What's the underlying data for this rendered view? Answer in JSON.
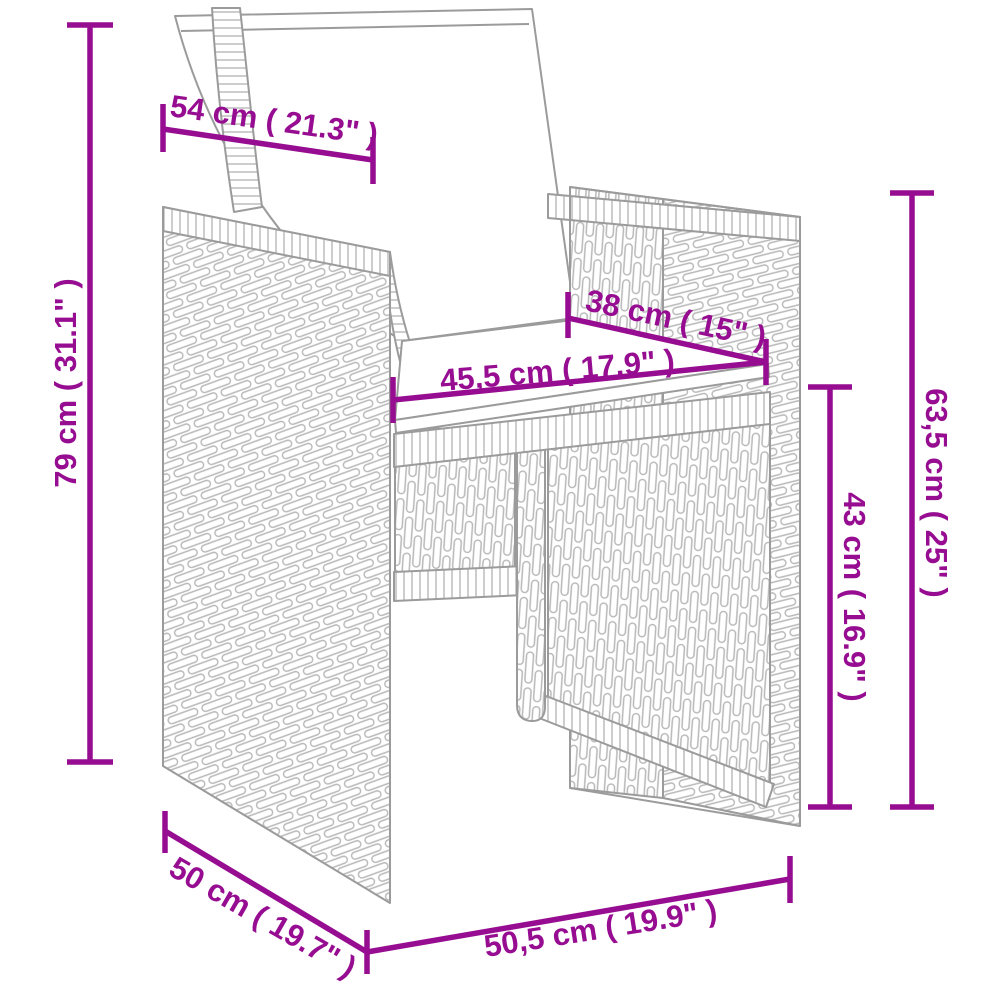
{
  "diagram": {
    "accent_color": "#970D91",
    "outline_color": "#9B9B9B",
    "dimensions": {
      "cushion_back_width": "54 cm ( 21.3\" )",
      "total_height": "79 cm ( 31.1\" )",
      "seat_depth": "38 cm ( 15\" )",
      "seat_width": "45,5 cm ( 17.9\" )",
      "armrest_height": "63,5 cm ( 25\" )",
      "seat_height": "43 cm ( 16.9\" )",
      "base_depth": "50 cm ( 19.7\" )",
      "base_width": "50,5 cm ( 19.9\" )"
    }
  }
}
